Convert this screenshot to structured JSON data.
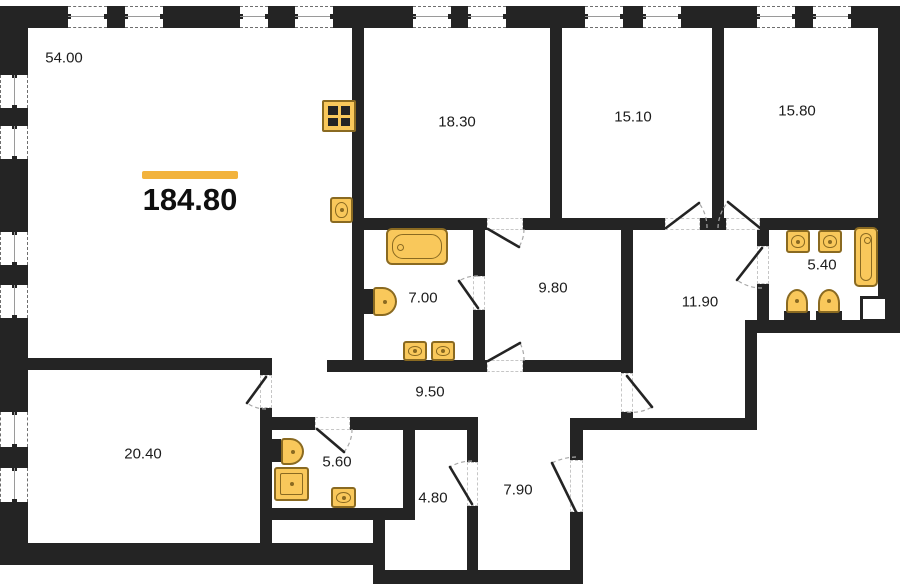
{
  "diagram": {
    "type": "apartment-floor-plan",
    "total_area_label": "184.80",
    "accent_color": "#F2B33D",
    "wall_color": "#242424",
    "fixture_fill_color": "#F9C85B",
    "fixture_border_color": "#8a6a21",
    "rooms": [
      {
        "label": "54.00",
        "cx": 64,
        "cy": 58
      },
      {
        "label": "18.30",
        "cx": 457,
        "cy": 122
      },
      {
        "label": "15.10",
        "cx": 633,
        "cy": 117
      },
      {
        "label": "15.80",
        "cx": 797,
        "cy": 111
      },
      {
        "label": "7.00",
        "cx": 423,
        "cy": 298
      },
      {
        "label": "9.80",
        "cx": 553,
        "cy": 288
      },
      {
        "label": "11.90",
        "cx": 700,
        "cy": 302
      },
      {
        "label": "5.40",
        "cx": 822,
        "cy": 265
      },
      {
        "label": "9.50",
        "cx": 430,
        "cy": 392
      },
      {
        "label": "20.40",
        "cx": 143,
        "cy": 454
      },
      {
        "label": "5.60",
        "cx": 337,
        "cy": 462
      },
      {
        "label": "4.80",
        "cx": 433,
        "cy": 498
      },
      {
        "label": "7.90",
        "cx": 518,
        "cy": 490
      }
    ],
    "fixtures": [
      {
        "name": "gas-stove-icon",
        "room": "54.00"
      },
      {
        "name": "kitchen-sink-icon",
        "room": "54.00"
      },
      {
        "name": "bathtub-icon",
        "room": "7.00"
      },
      {
        "name": "toilet-icon",
        "room": "7.00"
      },
      {
        "name": "washbasin-icon",
        "room": "7.00"
      },
      {
        "name": "washbasin-icon",
        "room": "7.00"
      },
      {
        "name": "washbasin-icon",
        "room": "5.40"
      },
      {
        "name": "washbasin-icon",
        "room": "5.40"
      },
      {
        "name": "bathtub-icon",
        "room": "5.40"
      },
      {
        "name": "toilet-icon",
        "room": "5.40"
      },
      {
        "name": "bidet-icon",
        "room": "5.40"
      },
      {
        "name": "toilet-icon",
        "room": "5.60"
      },
      {
        "name": "shower-tray-icon",
        "room": "5.60"
      },
      {
        "name": "washbasin-icon",
        "room": "5.60"
      }
    ]
  }
}
